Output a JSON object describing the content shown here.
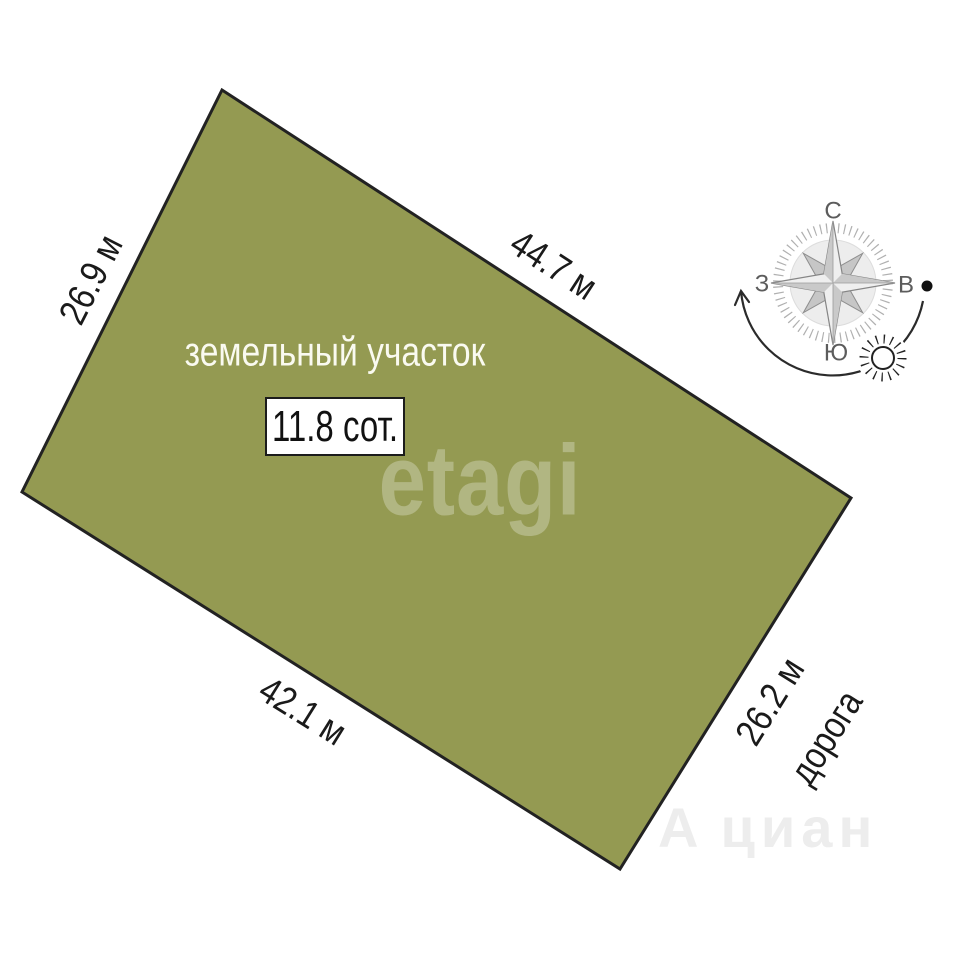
{
  "diagram": {
    "title": "земельный участок",
    "area_label": "11.8 сот.",
    "sides": {
      "left": "26.9 м",
      "top": "44.7 м",
      "bottom": "42.1 м",
      "right": "26.2 м"
    },
    "road_label": "дорога"
  },
  "compass": {
    "north": "С",
    "south": "Ю",
    "west": "З",
    "east": "В"
  },
  "icons": {
    "sun_icon": "sun with rays on the sun-path arc",
    "sun_path_arrow": "arc arrow from east dot to west",
    "compass_rose": "8-point compass rose with tick ring"
  },
  "watermarks": {
    "center": "etagi",
    "bottom_prefix": "А",
    "bottom": "циан"
  },
  "colors": {
    "plot_fill": "#949a52",
    "plot_outline": "#222222",
    "page_background": "#ffffff",
    "dimension_text": "#1a1a1a",
    "plot_title_text": "#fafaf0",
    "compass_text": "#5c5c5c"
  }
}
